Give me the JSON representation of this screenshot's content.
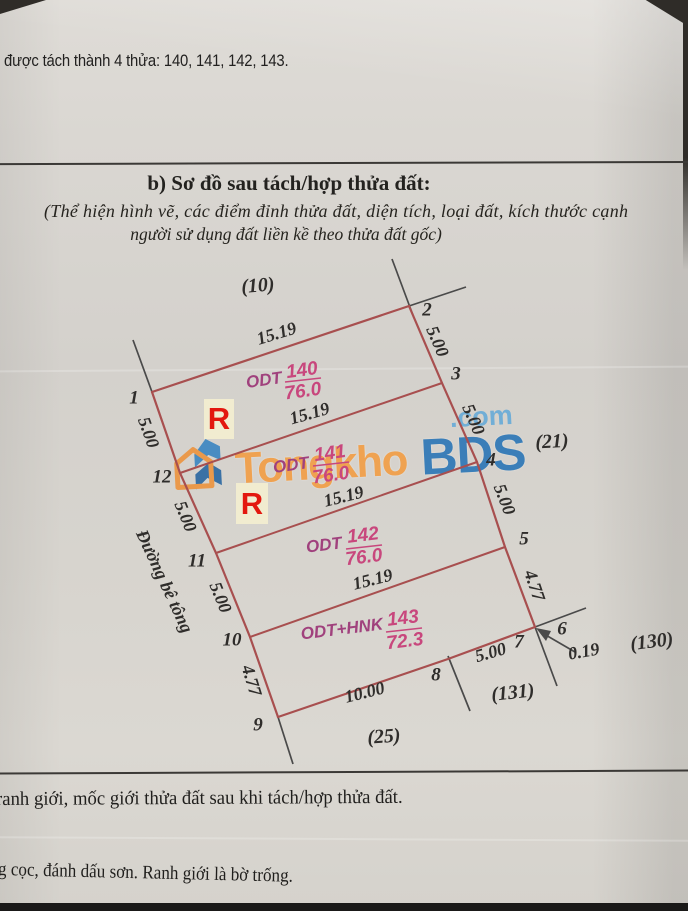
{
  "document": {
    "top_note": "được tách thành 4 thửa: 140, 141, 142, 143.",
    "section_title": "b) Sơ đồ sau tách/hợp thửa đất:",
    "section_subtitle_line1": "(Thể hiện hình vẽ, các điểm đỉnh thửa đất, diện tích, loại đất, kích thước cạnh",
    "section_subtitle_line2": "người sử dụng đất liền kề theo thửa đất gốc)",
    "footer_line1": "ranh giới, mốc giới thửa đất sau khi tách/hợp thửa đất.",
    "footer_line2": "g cọc, đánh dấu sơn. Ranh giới  là bờ trống."
  },
  "watermark": {
    "word1": "Tongkho",
    "word2": "BDS",
    "tld": ".com"
  },
  "diagram": {
    "road_label": "Đường bê tông",
    "plots": [
      {
        "use": "ODT",
        "number": "140",
        "area": "76.0"
      },
      {
        "use": "ODT",
        "number": "141",
        "area": "76.0"
      },
      {
        "use": "ODT",
        "number": "142",
        "area": "76.0"
      },
      {
        "use": "ODT+HNK",
        "number": "143",
        "area": "72.3"
      }
    ],
    "neighbors": {
      "top": "(10)",
      "right": "(21)",
      "far_right": "(130)",
      "bottom_right": "(131)",
      "bottom": "(25)"
    },
    "vertices": {
      "v1": "1",
      "v2": "2",
      "v3": "3",
      "v4": "4",
      "v5": "5",
      "v6": "6",
      "v7": "7",
      "v8": "8",
      "v9": "9",
      "v10": "10",
      "v11": "11",
      "v12": "12"
    },
    "edges": {
      "e1_2": "15.19",
      "e12_3": "15.19",
      "e11_4": "15.19",
      "e10_5": "15.19",
      "e2_3": "5.00",
      "e3_4": "5.00",
      "e4_5": "5.00",
      "e5_7": "4.77",
      "e1_12": "5.00",
      "e12_11": "5.00",
      "e11_10": "5.00",
      "e10_9": "4.77",
      "e9_8": "10.00",
      "e8_7": "5.00",
      "e6_7": "0.19"
    },
    "markers": {
      "r1": "R",
      "r2": "R"
    }
  },
  "colors": {
    "parcel_line": "#a84f4f",
    "boundary_line": "#4a4a4a",
    "label_pink": "#c8477d",
    "label_purple": "#a0417d",
    "marker_red": "#e3180f",
    "watermark_orange": "#f4993a",
    "watermark_blue": "#1e6fb5",
    "paper": "#d7d4ce"
  }
}
